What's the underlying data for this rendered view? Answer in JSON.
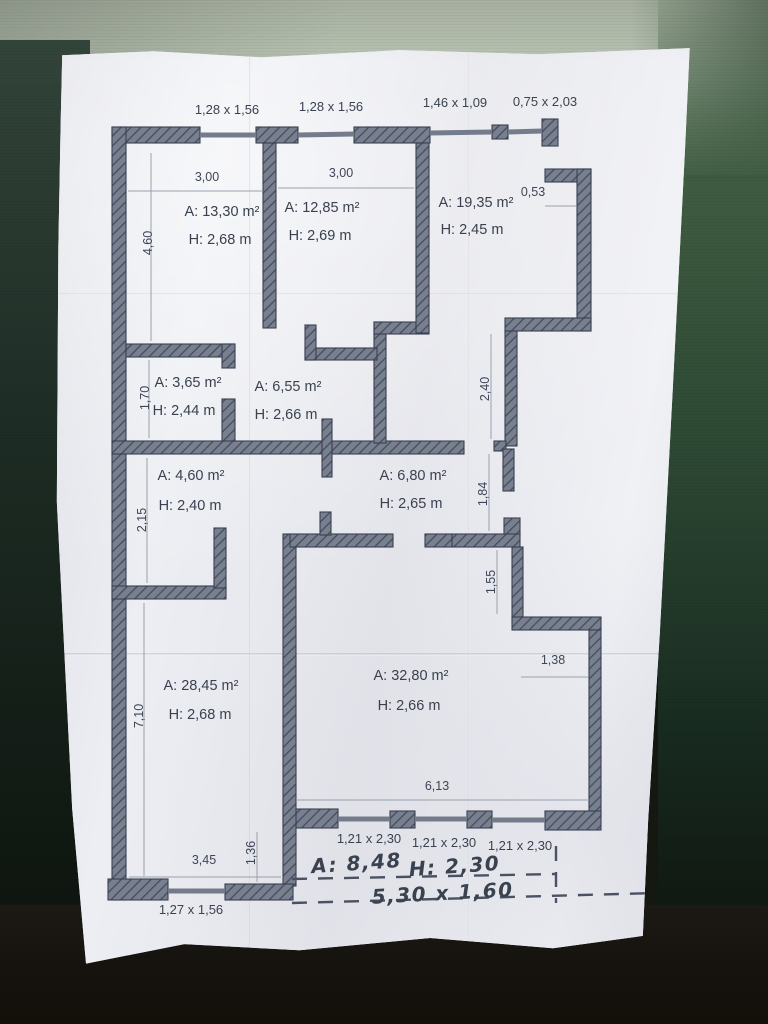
{
  "photo": {
    "subject": "floor plan sketch on crumpled paper",
    "paper_color": "#e8e9ee",
    "ink_color": "#3a424f",
    "wall_fill": "#78808f",
    "wall_hatch": "#454d5c",
    "background_top": "#bcc7b6",
    "background_side": "#2c4733",
    "background_bottom": "#16130f"
  },
  "plan": {
    "rooms": [
      {
        "id": "room-13-30",
        "area": "A: 13,30 m²",
        "height": "H: 2,68 m"
      },
      {
        "id": "room-12-85",
        "area": "A: 12,85 m²",
        "height": "H: 2,69 m"
      },
      {
        "id": "room-19-35",
        "area": "A: 19,35 m²",
        "height": "H: 2,45 m"
      },
      {
        "id": "room-3-65",
        "area": "A: 3,65 m²",
        "height": "H: 2,44 m"
      },
      {
        "id": "room-6-55",
        "area": "A: 6,55 m²",
        "height": "H: 2,66 m"
      },
      {
        "id": "room-4-60",
        "area": "A: 4,60 m²",
        "height": "H: 2,40 m"
      },
      {
        "id": "room-6-80",
        "area": "A: 6,80 m²",
        "height": "H: 2,65 m"
      },
      {
        "id": "room-28-45",
        "area": "A: 28,45 m²",
        "height": "H: 2,68 m"
      },
      {
        "id": "room-32-80",
        "area": "A: 32,80 m²",
        "height": "H: 2,66 m"
      }
    ],
    "labels": [
      {
        "id": "window-top-1",
        "text": "1,28 x 1,56",
        "x": 227,
        "y": 114,
        "cls": "t-win"
      },
      {
        "id": "window-top-2",
        "text": "1,28 x 1,56",
        "x": 331,
        "y": 111,
        "cls": "t-win"
      },
      {
        "id": "window-top-3",
        "text": "1,46 x 1,09",
        "x": 455,
        "y": 107,
        "cls": "t-win"
      },
      {
        "id": "window-top-4",
        "text": "0,75 x 2,03",
        "x": 545,
        "y": 106,
        "cls": "t-win"
      },
      {
        "id": "dim-3-00-a",
        "text": "3,00",
        "x": 207,
        "y": 181,
        "cls": "t-dim"
      },
      {
        "id": "dim-3-00-b",
        "text": "3,00",
        "x": 341,
        "y": 177,
        "cls": "t-dim"
      },
      {
        "id": "dim-0-53",
        "text": "0,53",
        "x": 533,
        "y": 196,
        "cls": "t-dim"
      },
      {
        "id": "dim-4-60",
        "text": "4,60",
        "x": 152,
        "y": 243,
        "cls": "t-dim",
        "rot": -90
      },
      {
        "id": "dim-1-70",
        "text": "1,70",
        "x": 149,
        "y": 398,
        "cls": "t-dim",
        "rot": -90
      },
      {
        "id": "dim-2-15",
        "text": "2,15",
        "x": 146,
        "y": 520,
        "cls": "t-dim",
        "rot": -90
      },
      {
        "id": "dim-7-10",
        "text": "7,10",
        "x": 143,
        "y": 716,
        "cls": "t-dim",
        "rot": -90
      },
      {
        "id": "dim-2-40",
        "text": "2,40",
        "x": 489,
        "y": 389,
        "cls": "t-dim",
        "rot": -90
      },
      {
        "id": "dim-1-84",
        "text": "1,84",
        "x": 487,
        "y": 494,
        "cls": "t-dim",
        "rot": -90
      },
      {
        "id": "dim-1-55",
        "text": "1,55",
        "x": 495,
        "y": 582,
        "cls": "t-dim",
        "rot": -90
      },
      {
        "id": "dim-1-38",
        "text": "1,38",
        "x": 553,
        "y": 664,
        "cls": "t-dim"
      },
      {
        "id": "dim-1-36",
        "text": "1,36",
        "x": 255,
        "y": 853,
        "cls": "t-dim",
        "rot": -90
      },
      {
        "id": "dim-3-45",
        "text": "3,45",
        "x": 204,
        "y": 864,
        "cls": "t-dim"
      },
      {
        "id": "dim-6-13",
        "text": "6,13",
        "x": 437,
        "y": 790,
        "cls": "t-dim"
      },
      {
        "id": "room-13-30-area",
        "text": "A: 13,30 m²",
        "x": 222,
        "y": 216,
        "cls": "t-room"
      },
      {
        "id": "room-13-30-height",
        "text": "H: 2,68 m",
        "x": 220,
        "y": 244,
        "cls": "t-room"
      },
      {
        "id": "room-12-85-area",
        "text": "A: 12,85 m²",
        "x": 322,
        "y": 212,
        "cls": "t-room"
      },
      {
        "id": "room-12-85-height",
        "text": "H: 2,69 m",
        "x": 320,
        "y": 240,
        "cls": "t-room"
      },
      {
        "id": "room-19-35-area",
        "text": "A: 19,35 m²",
        "x": 476,
        "y": 207,
        "cls": "t-room"
      },
      {
        "id": "room-19-35-height",
        "text": "H: 2,45 m",
        "x": 472,
        "y": 234,
        "cls": "t-room"
      },
      {
        "id": "room-3-65-area",
        "text": "A: 3,65 m²",
        "x": 188,
        "y": 387,
        "cls": "t-room"
      },
      {
        "id": "room-3-65-height",
        "text": "H: 2,44 m",
        "x": 184,
        "y": 415,
        "cls": "t-room"
      },
      {
        "id": "room-6-55-area",
        "text": "A: 6,55 m²",
        "x": 288,
        "y": 391,
        "cls": "t-room"
      },
      {
        "id": "room-6-55-height",
        "text": "H: 2,66 m",
        "x": 286,
        "y": 419,
        "cls": "t-room"
      },
      {
        "id": "room-4-60-area",
        "text": "A: 4,60 m²",
        "x": 191,
        "y": 480,
        "cls": "t-room"
      },
      {
        "id": "room-4-60-height",
        "text": "H: 2,40 m",
        "x": 190,
        "y": 510,
        "cls": "t-room"
      },
      {
        "id": "room-6-80-area",
        "text": "A: 6,80 m²",
        "x": 413,
        "y": 480,
        "cls": "t-room"
      },
      {
        "id": "room-6-80-height",
        "text": "H: 2,65 m",
        "x": 411,
        "y": 508,
        "cls": "t-room"
      },
      {
        "id": "room-28-45-area",
        "text": "A: 28,45 m²",
        "x": 201,
        "y": 690,
        "cls": "t-room"
      },
      {
        "id": "room-28-45-height",
        "text": "H: 2,68 m",
        "x": 200,
        "y": 719,
        "cls": "t-room"
      },
      {
        "id": "room-32-80-area",
        "text": "A: 32,80 m²",
        "x": 411,
        "y": 680,
        "cls": "t-room"
      },
      {
        "id": "room-32-80-height",
        "text": "H: 2,66 m",
        "x": 409,
        "y": 710,
        "cls": "t-room"
      },
      {
        "id": "window-bottom-1",
        "text": "1,21 x 2,30",
        "x": 369,
        "y": 843,
        "cls": "t-win"
      },
      {
        "id": "window-bottom-2",
        "text": "1,21 x 2,30",
        "x": 444,
        "y": 847,
        "cls": "t-win"
      },
      {
        "id": "window-bottom-3",
        "text": "1,21 x 2,30",
        "x": 520,
        "y": 850,
        "cls": "t-win"
      },
      {
        "id": "window-bottom-4",
        "text": "1,27 x 1,56",
        "x": 191,
        "y": 914,
        "cls": "t-win"
      },
      {
        "id": "handwritten-area",
        "text": "A: 8,48",
        "x": 357,
        "y": 870,
        "cls": "t-hand",
        "rot": -4
      },
      {
        "id": "handwritten-height",
        "text": "H: 2,30",
        "x": 455,
        "y": 873,
        "cls": "t-hand",
        "rot": -4
      },
      {
        "id": "handwritten-size",
        "text": "5,30 x 1,60",
        "x": 443,
        "y": 900,
        "cls": "t-hand",
        "rot": -3
      }
    ]
  }
}
